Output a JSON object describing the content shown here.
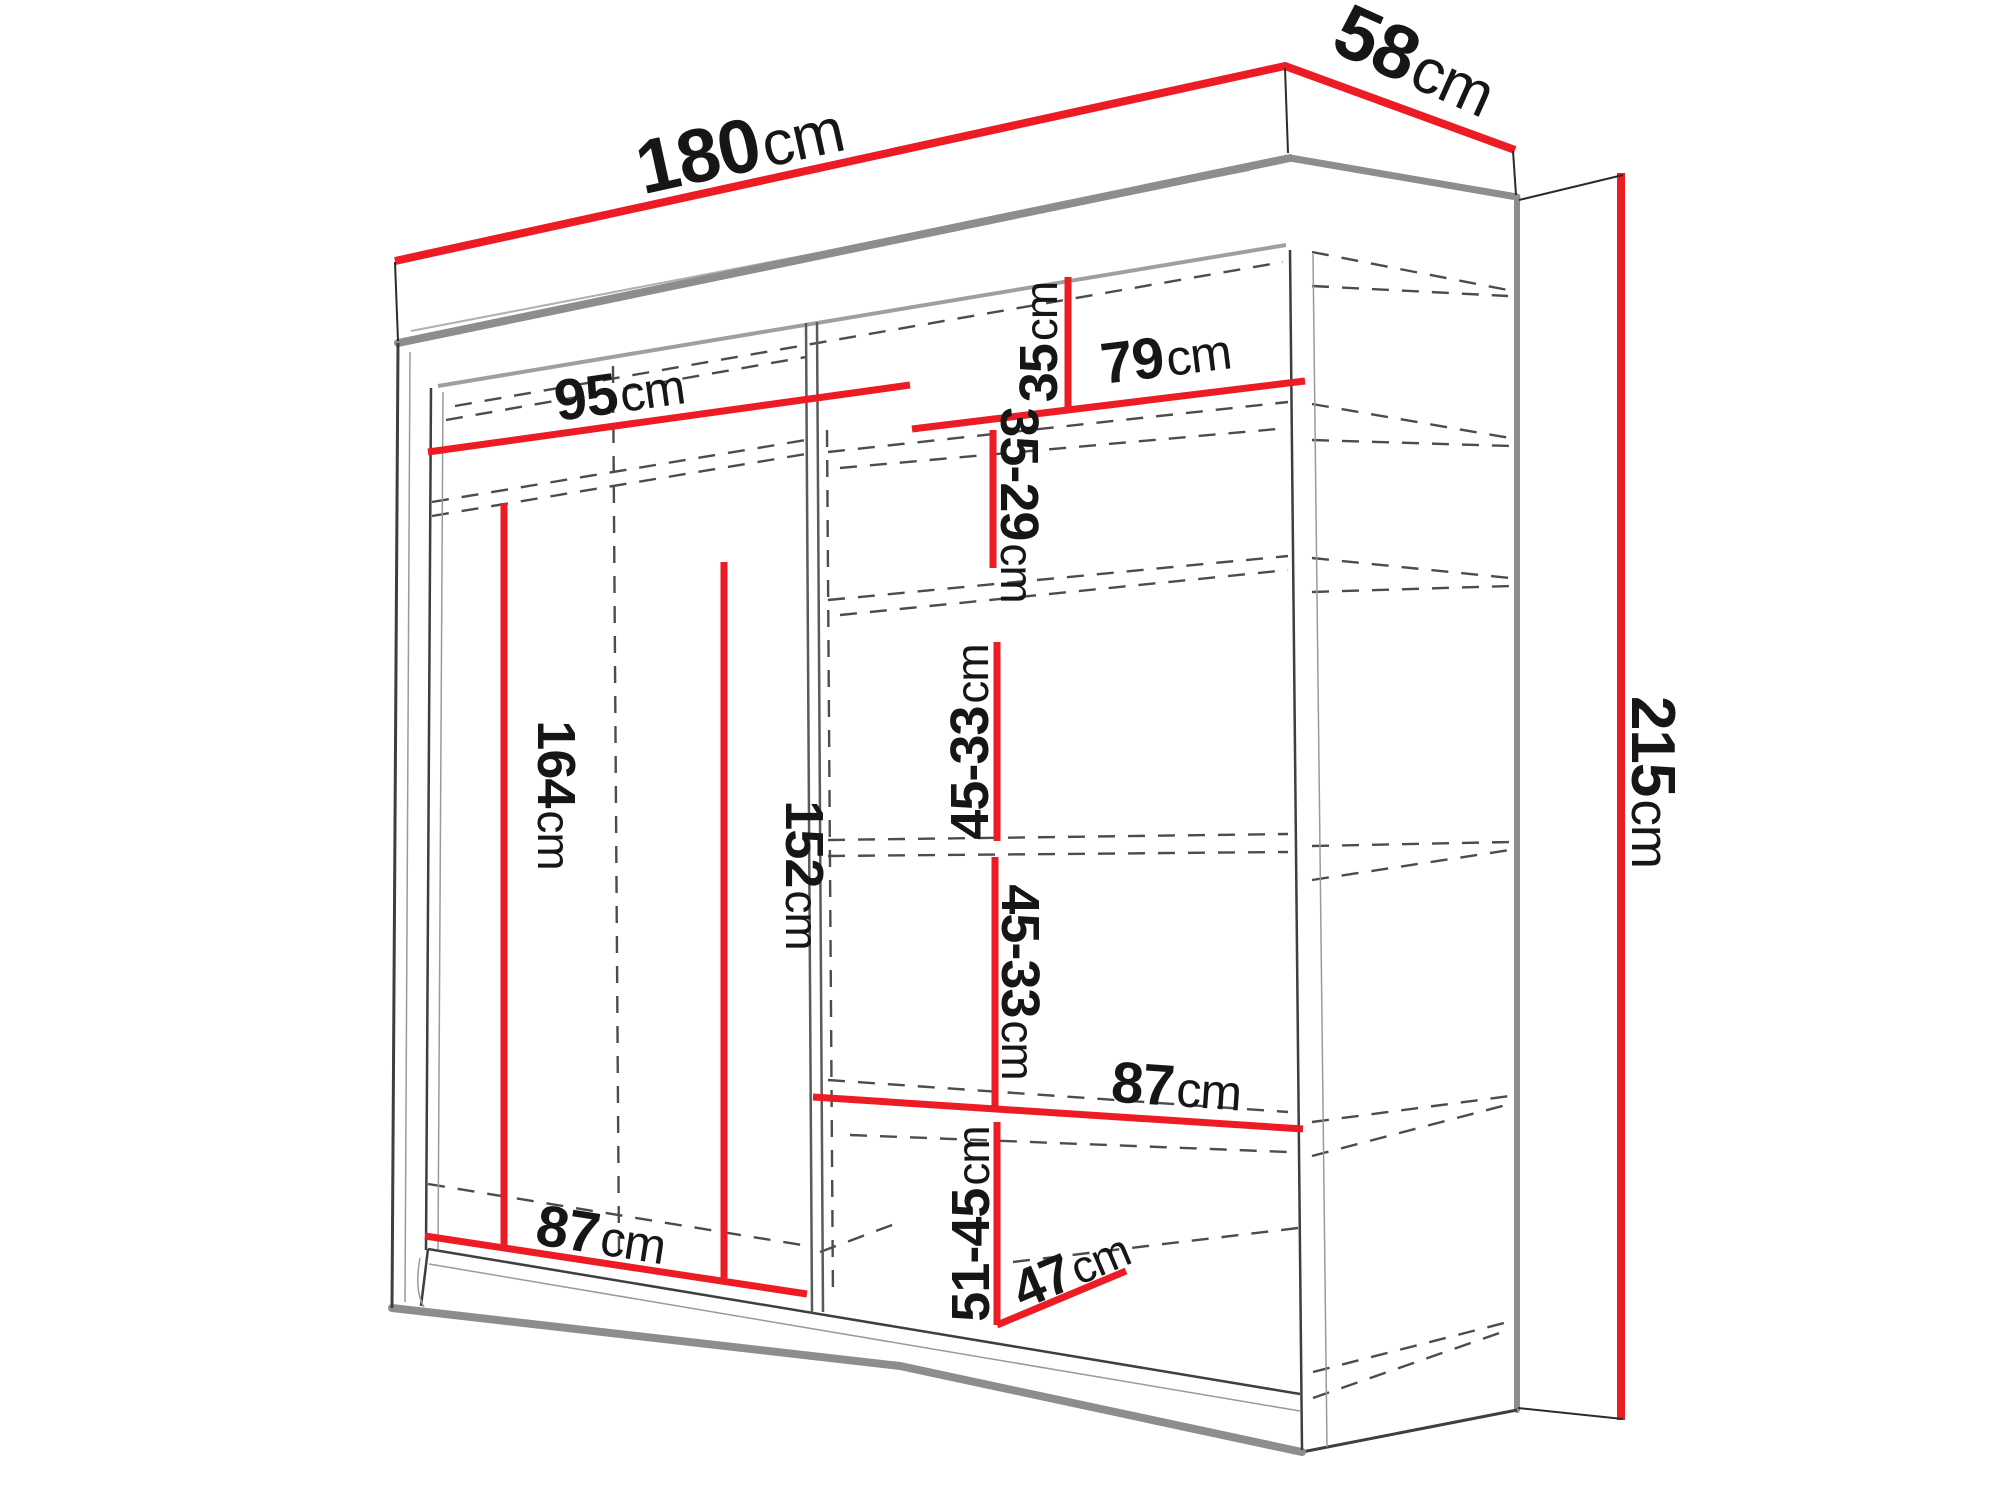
{
  "diagram": {
    "type": "wardrobe-dimension-diagram",
    "unit": "cm",
    "colors": {
      "dimension_line": "#ed1b24",
      "cabinet_edge": "#8d8d8d",
      "hidden_edge_dashed": "#4c4c4c",
      "text": "#161616",
      "background": "#ffffff"
    },
    "dims": {
      "width": {
        "value": "180",
        "unit": "cm"
      },
      "depth": {
        "value": "58",
        "unit": "cm"
      },
      "height": {
        "value": "215",
        "unit": "cm"
      },
      "left_top_width": {
        "value": "95",
        "unit": "cm"
      },
      "right_top_gap": {
        "value": "35",
        "unit": "cm"
      },
      "right_shelf_width": {
        "value": "79",
        "unit": "cm"
      },
      "right_gap_1": {
        "value": "35-29",
        "unit": "cm"
      },
      "right_gap_2": {
        "value": "45-33",
        "unit": "cm"
      },
      "right_gap_3": {
        "value": "45-33",
        "unit": "cm"
      },
      "left_rod_height": {
        "value": "164",
        "unit": "cm"
      },
      "left_inner_height": {
        "value": "152",
        "unit": "cm"
      },
      "right_bottom_width": {
        "value": "87",
        "unit": "cm"
      },
      "right_bottom_gap": {
        "value": "51-45",
        "unit": "cm"
      },
      "bottom_shelf_depth": {
        "value": "47",
        "unit": "cm"
      },
      "left_bottom_width": {
        "value": "87",
        "unit": "cm"
      }
    }
  }
}
